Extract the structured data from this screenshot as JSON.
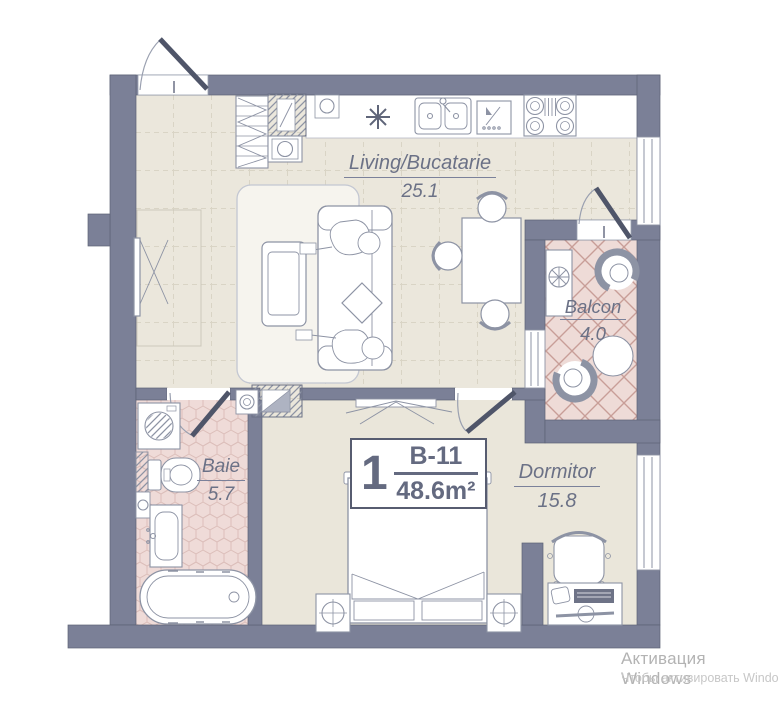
{
  "rooms": {
    "living": {
      "name": "Living/Bucatarie",
      "area": "25.1"
    },
    "balcony": {
      "name": "Balcon",
      "area": "4.0"
    },
    "bath": {
      "name": "Baie",
      "area": "5.7"
    },
    "bedroom": {
      "name": "Dormitor",
      "area": "15.8"
    }
  },
  "unit": {
    "room_count": "1",
    "unit_code": "B-11",
    "total_area": "48.6m²"
  },
  "watermark": {
    "line1": "Активация Windows",
    "line2": "Чтобы активировать Windo"
  },
  "colors": {
    "wall": "#7b8097",
    "living_floor": "#ebe7dc",
    "bath_floor": "#efdbd8",
    "balcony_floor": "#eedbd7",
    "label_text": "#6b7186"
  }
}
